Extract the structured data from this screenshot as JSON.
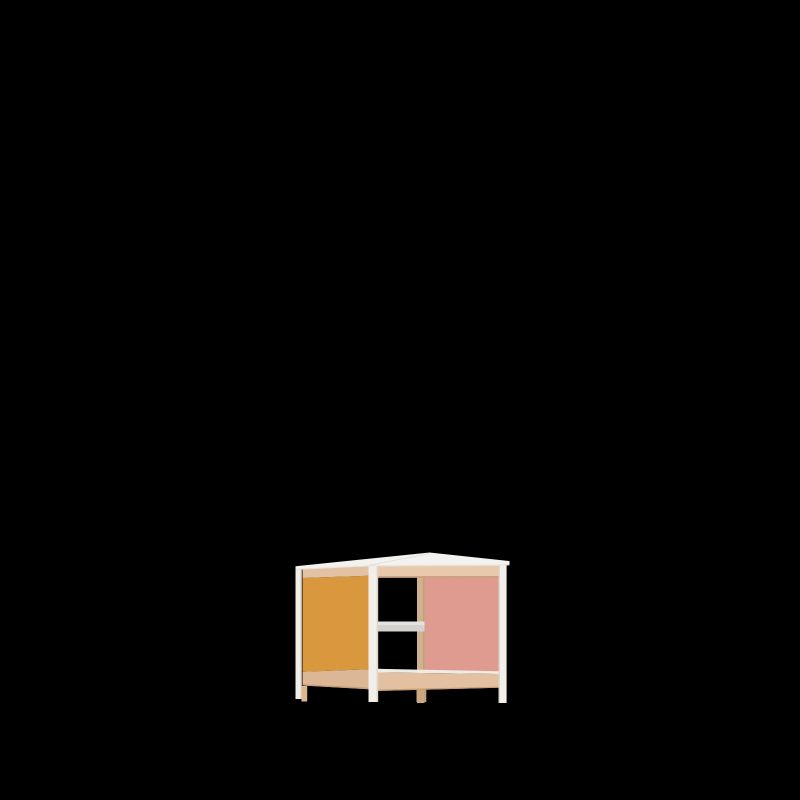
{
  "scene": {
    "description": "3D render of a small open-frame kids play table on a plain black background",
    "object_label": "wooden play table with orange side panel and pink back panel",
    "background_label": "solid black backdrop"
  },
  "colors": {
    "background": "#000000",
    "tabletop_white": "#F4F2EF",
    "tabletop_edge": "#E7E4E0",
    "tabletop_seam": "#DEDBD5",
    "post_white": "#F2EFEB",
    "post_shadow": "#DCD5CC",
    "rail_wood": "#E8C9AB",
    "rail_wood_top": "#F1D8BD",
    "rail_wood_left": "#E3C2A3",
    "rail_wood_dark_edge": "#C49C77",
    "rail_bottom_wood": "#E2C0A0",
    "rail_bottom_left": "#DCB795",
    "rail_white_lip": "#EFECE7",
    "panel_orange": "#D9983E",
    "panel_pink": "#E09B90",
    "crossbar_gray": "#D5D2CE",
    "crossbar_highlight": "#E5E3DF",
    "back_post_wood": "#CFB190",
    "back_post_edge": "#BEA07B",
    "foot_wood": "#C9A67E",
    "leg_inner_wood": "#DDB58E"
  }
}
